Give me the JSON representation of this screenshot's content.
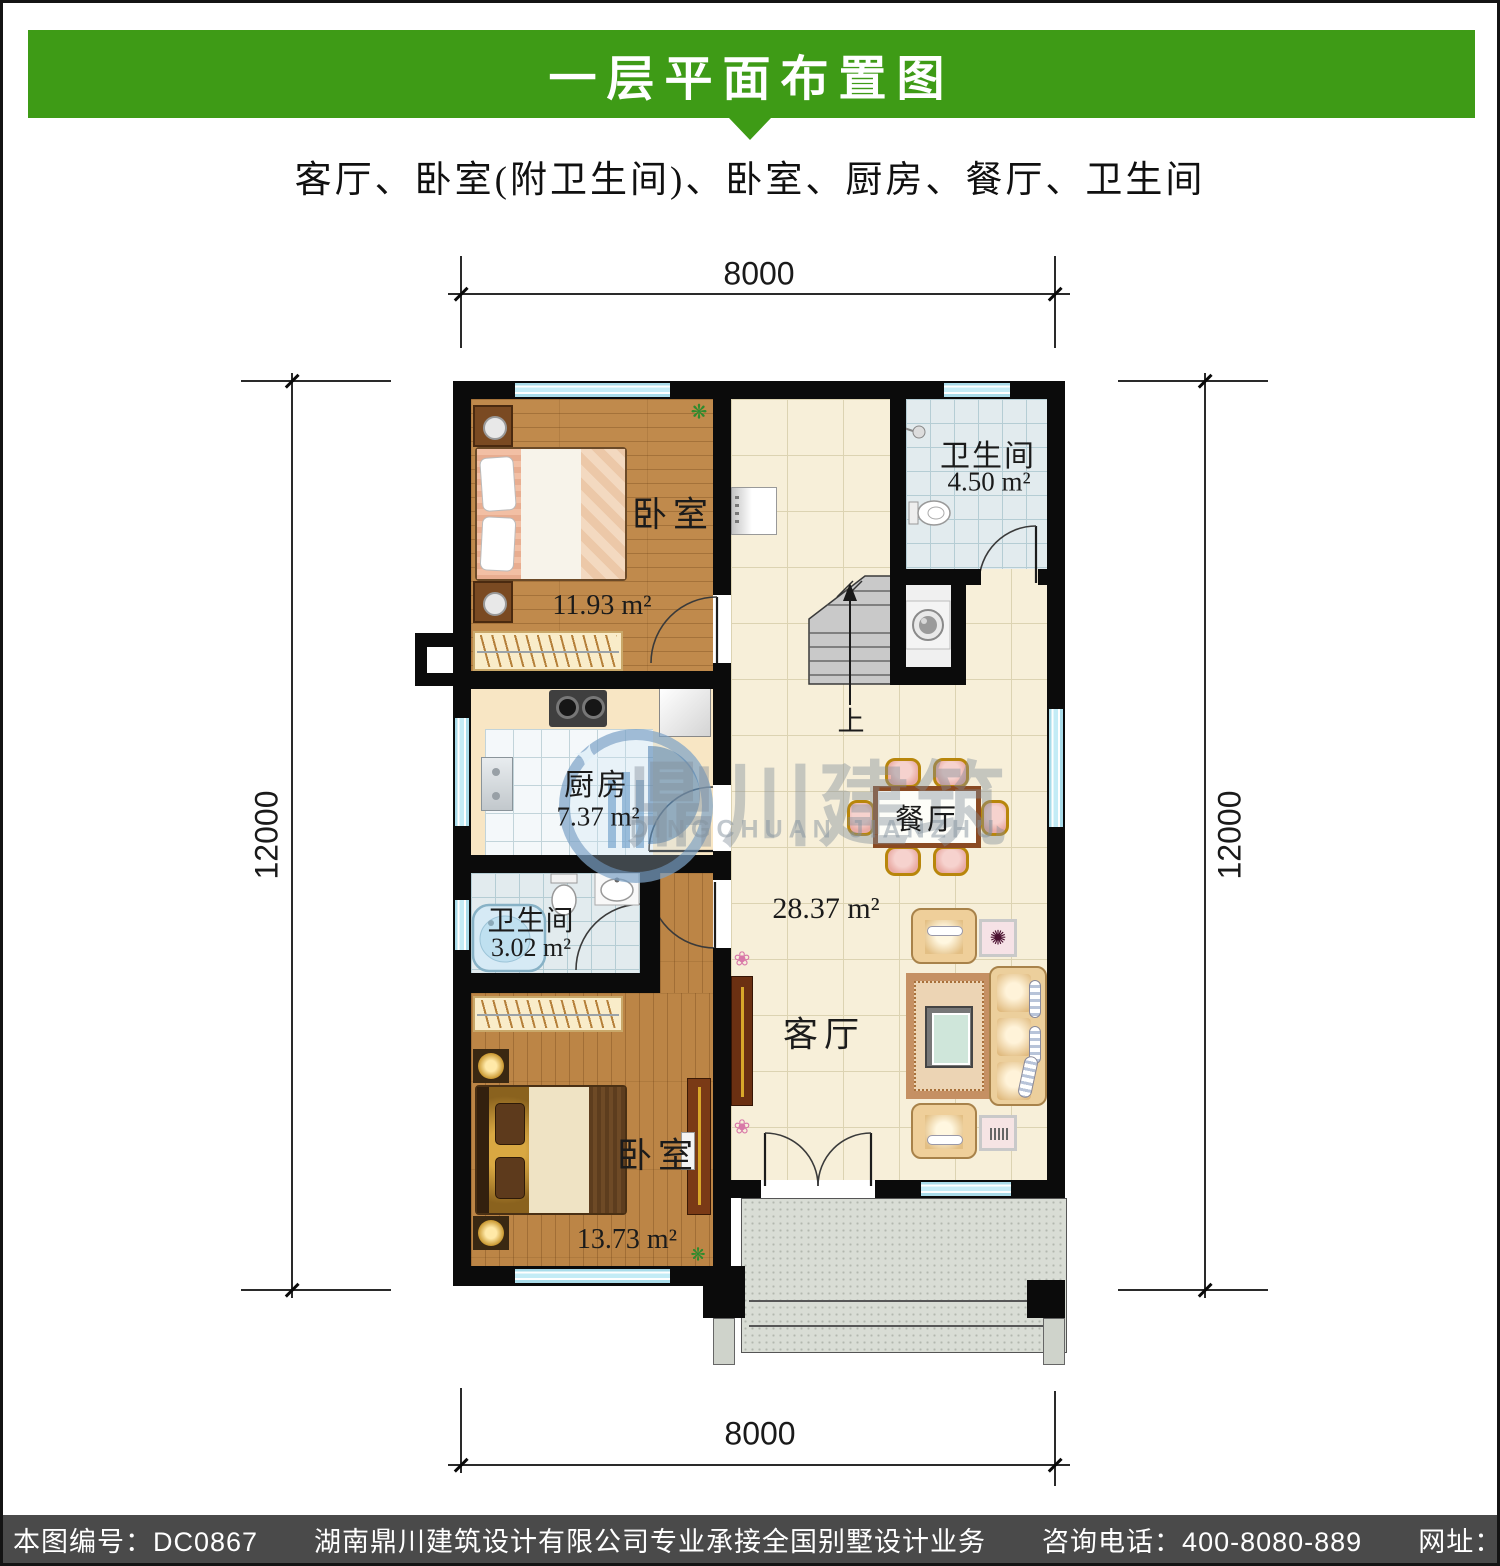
{
  "header": {
    "title": "一层平面布置图"
  },
  "subtitle": "客厅、卧室(附卫生间)、卧室、厨房、餐厅、卫生间",
  "dimensions": {
    "top": "8000",
    "bottom": "8000",
    "left": "12000",
    "right": "12000"
  },
  "rooms": {
    "bedroom_top": {
      "name": "卧室",
      "area": "11.93 m²"
    },
    "bathroom_top": {
      "name": "卫生间",
      "area": "4.50 m²"
    },
    "kitchen": {
      "name": "厨房",
      "area": "7.37 m²"
    },
    "bathroom_small": {
      "name": "卫生间",
      "area": "3.02 m²"
    },
    "dining": {
      "name": "餐厅"
    },
    "living": {
      "name": "客厅",
      "area": "28.37 m²"
    },
    "bedroom_bottom": {
      "name": "卧室",
      "area": "13.73 m²"
    }
  },
  "stairs": {
    "up_label": "上"
  },
  "watermark": {
    "cn": "鼎川建筑",
    "en": "DINGCHUAN JIANZHU"
  },
  "footer": {
    "text": "本图编号：DC0867　　湖南鼎川建筑设计有限公司专业承接全国别墅设计业务　　咨询电话：400-8080-889　　网址：www.bstzcs.com"
  },
  "colors": {
    "accent_green": "#3E9B16",
    "footer_gray": "#4A4A4A",
    "wall_black": "#0B0B0B",
    "window_blue": "#C4ECF6"
  }
}
